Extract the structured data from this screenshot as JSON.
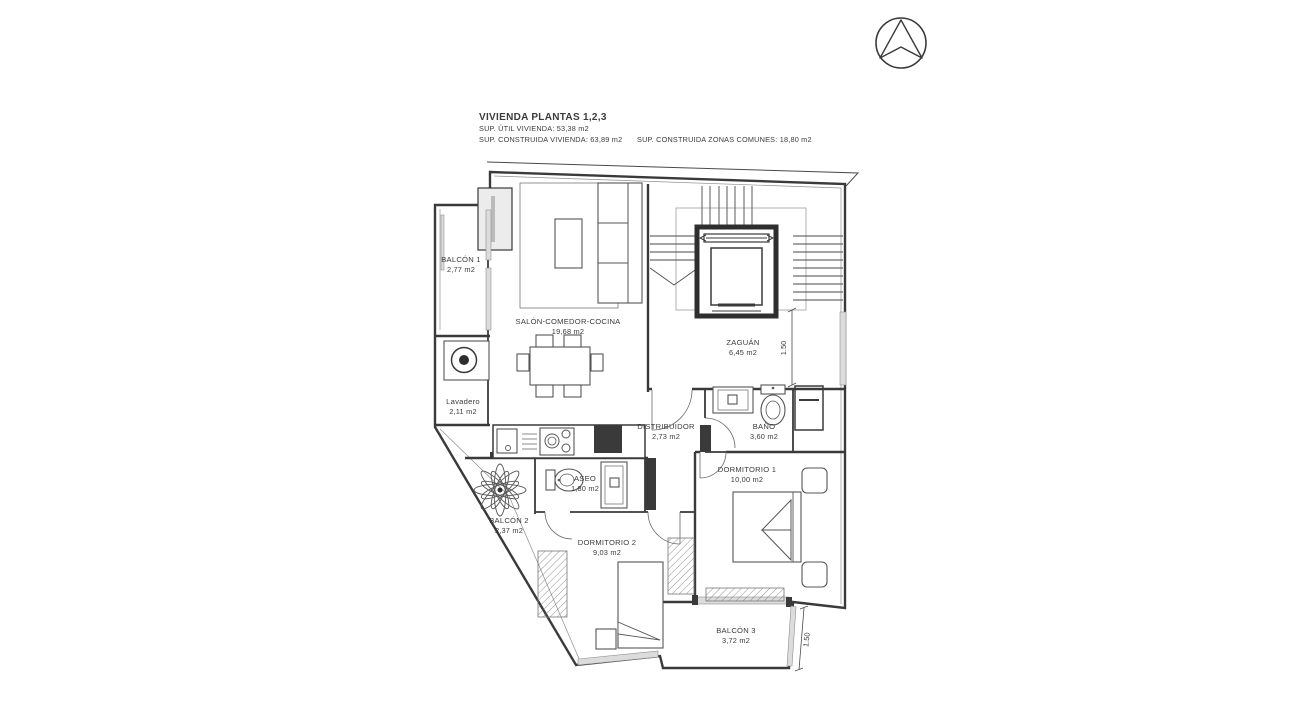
{
  "drawing": {
    "type": "architectural-floor-plan",
    "title_block": {
      "line1": "VIVIENDA PLANTAS 1,2,3",
      "line2": "SUP. ÚTIL VIVIENDA: 53,38 m2",
      "line3": "SUP. CONSTRUIDA VIVIENDA: 63,89 m2",
      "line4": "SUP. CONSTRUIDA ZONAS COMUNES: 18,80 m2"
    },
    "rooms": [
      {
        "name": "BALCÓN 1",
        "area": "2,77 m2"
      },
      {
        "name": "SALÓN-COMEDOR-COCINA",
        "area": "19,68 m2"
      },
      {
        "name": "ZAGUÁN",
        "area": "6,45 m2"
      },
      {
        "name": "Lavadero",
        "area": "2,11 m2"
      },
      {
        "name": "DISTRIBUIDOR",
        "area": "2,73 m2"
      },
      {
        "name": "BAÑO",
        "area": "3,60 m2"
      },
      {
        "name": "ASEO",
        "area": "1,80 m2"
      },
      {
        "name": "DORMITORIO 1",
        "area": "10,00 m2"
      },
      {
        "name": "DORMITORIO 2",
        "area": "9,03 m2"
      },
      {
        "name": "BALCÓN 2",
        "area": "2,37 m2"
      },
      {
        "name": "BALCÓN 3",
        "area": "3,72 m2"
      }
    ],
    "dimensions": [
      {
        "label": "1.50"
      },
      {
        "label": "1.50"
      }
    ],
    "icons": [
      {
        "name": "north-arrow-icon",
        "meaning": "compass north arrow"
      }
    ],
    "colors": {
      "background": "#ffffff",
      "line": "#3a3a3a",
      "text": "#3b3b3b",
      "wall_fill": "#3a3a3a",
      "glass": "#dcdcdc",
      "light_line": "#8f8f8f"
    }
  }
}
